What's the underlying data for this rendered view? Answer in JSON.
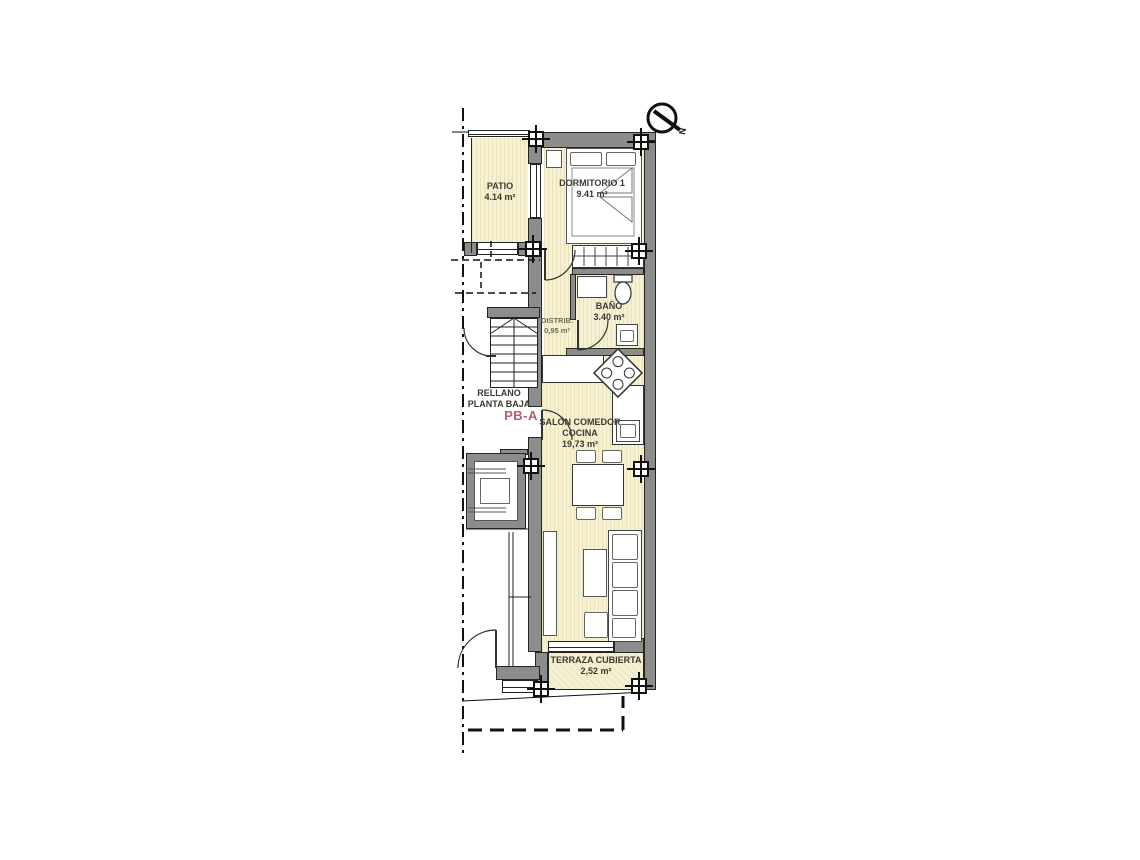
{
  "meta": {
    "drawing_type": "residential floor plan",
    "floor": "ground floor unit"
  },
  "colors": {
    "wall_gray": "#8c8c8c",
    "room_fill": "#f7f1d3",
    "room_stripe": "#e9e2bd",
    "label_text": "#3a3a32",
    "distrib_text": "#6f6f58",
    "unit_code_red": "#b65f6d"
  },
  "compass": {
    "label": "N"
  },
  "rooms": [
    {
      "name": "PATIO",
      "area": "4.14 m²"
    },
    {
      "name": "DORMITORIO 1",
      "area": "9.41 m²"
    },
    {
      "name": "BAÑO",
      "area": "3.40 m²"
    },
    {
      "name": "DISTRIB.",
      "area": "0,95 m²"
    },
    {
      "name": "SALÓN COMEDOR",
      "name2": "COCINA",
      "area": "19,73 m²"
    },
    {
      "name": "TERRAZA CUBIERTA",
      "area": "2,52 m²"
    }
  ],
  "landing": {
    "line1": "RELLANO",
    "line2": "PLANTA BAJA",
    "unit_code": "PB-A"
  }
}
